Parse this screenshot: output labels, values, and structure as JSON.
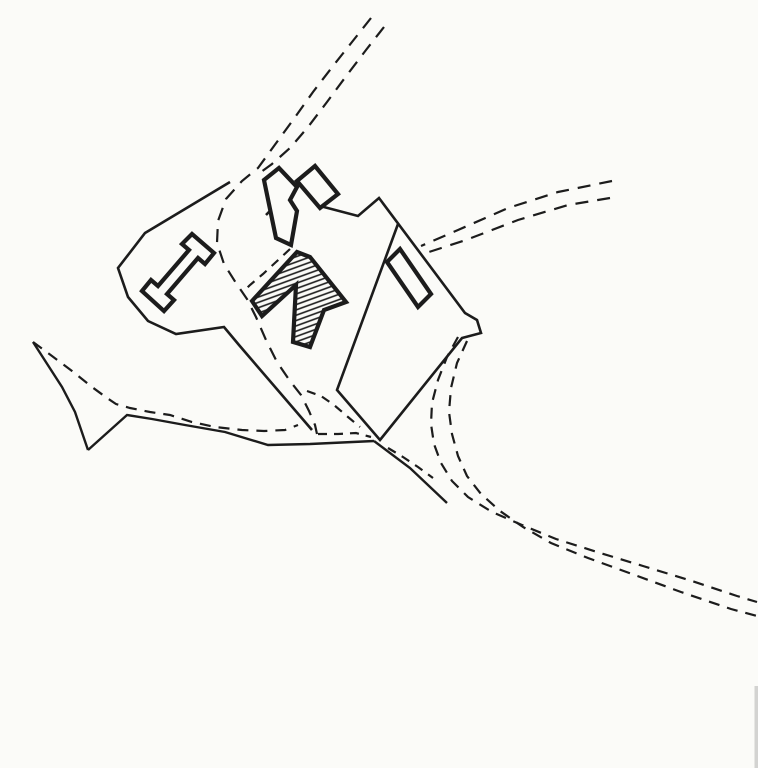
{
  "canvas": {
    "width": 758,
    "height": 768,
    "background": "#fbfbf8",
    "ink": "#1c1c1c"
  },
  "hatch": {
    "angle_deg": -20,
    "spacing": 5,
    "stroke_width": 1.6
  },
  "styles": {
    "wall": {
      "width": 2.6,
      "dash": ""
    },
    "building": {
      "width": 4.2,
      "dash": ""
    },
    "road_solid": {
      "width": 2.4,
      "dash": ""
    },
    "road_dashed": {
      "width": 2.2,
      "dash": "13 9"
    },
    "track_dashed": {
      "width": 2.2,
      "dash": "11 8"
    },
    "inner_dashed": {
      "width": 2.2,
      "dash": "9 7"
    }
  },
  "shapes": [
    {
      "name": "north-approach-road-west-line",
      "type": "polyline",
      "style": "road_dashed",
      "fill": "none",
      "points": [
        [
          371,
          18
        ],
        [
          352,
          42
        ],
        [
          333,
          66
        ],
        [
          313,
          92
        ],
        [
          293,
          120
        ],
        [
          274,
          146
        ],
        [
          258,
          168
        ],
        [
          242,
          181
        ],
        [
          226,
          199
        ],
        [
          218,
          221
        ],
        [
          217,
          243
        ],
        [
          224,
          264
        ],
        [
          236,
          283
        ],
        [
          247,
          299
        ],
        [
          256,
          317
        ],
        [
          266,
          340
        ],
        [
          277,
          362
        ],
        [
          290,
          381
        ],
        [
          301,
          395
        ],
        [
          309,
          411
        ],
        [
          315,
          425
        ],
        [
          317,
          434
        ]
      ]
    },
    {
      "name": "north-approach-road-east-line",
      "type": "polyline",
      "style": "road_dashed",
      "fill": "none",
      "points": [
        [
          384,
          27
        ],
        [
          366,
          50
        ],
        [
          347,
          75
        ],
        [
          327,
          102
        ],
        [
          308,
          127
        ],
        [
          290,
          148
        ],
        [
          272,
          164
        ],
        [
          261,
          172
        ]
      ]
    },
    {
      "name": "inner-track-east-edge",
      "type": "polyline",
      "style": "inner_dashed",
      "fill": "none",
      "points": [
        [
          290,
          249
        ],
        [
          276,
          262
        ],
        [
          263,
          274
        ],
        [
          250,
          285
        ],
        [
          244,
          291
        ]
      ]
    },
    {
      "name": "inner-fork-east-branch",
      "type": "polyline",
      "style": "inner_dashed",
      "fill": "none",
      "points": [
        [
          307,
          391
        ],
        [
          321,
          396
        ],
        [
          334,
          405
        ],
        [
          348,
          417
        ],
        [
          360,
          427
        ]
      ]
    },
    {
      "name": "inner-fork-south-branch",
      "type": "polyline",
      "style": "inner_dashed",
      "fill": "none",
      "points": [
        [
          318,
          434
        ],
        [
          338,
          434
        ],
        [
          356,
          433
        ],
        [
          371,
          437
        ]
      ]
    },
    {
      "name": "east-road-north-line",
      "type": "polyline",
      "style": "road_dashed",
      "fill": "none",
      "points": [
        [
          612,
          181
        ],
        [
          558,
          192
        ],
        [
          508,
          208
        ],
        [
          458,
          230
        ],
        [
          421,
          246
        ]
      ]
    },
    {
      "name": "east-road-south-line",
      "type": "polyline",
      "style": "road_dashed",
      "fill": "none",
      "points": [
        [
          610,
          198
        ],
        [
          568,
          205
        ],
        [
          518,
          220
        ],
        [
          466,
          240
        ],
        [
          429,
          252
        ]
      ]
    },
    {
      "name": "bypass-track-west-line",
      "type": "polyline",
      "style": "track_dashed",
      "fill": "none",
      "points": [
        [
          458,
          337
        ],
        [
          447,
          357
        ],
        [
          438,
          380
        ],
        [
          432,
          403
        ],
        [
          431,
          424
        ],
        [
          434,
          444
        ],
        [
          441,
          463
        ],
        [
          452,
          481
        ],
        [
          468,
          497
        ],
        [
          492,
          512
        ],
        [
          522,
          525
        ],
        [
          556,
          539
        ],
        [
          597,
          552
        ],
        [
          643,
          566
        ],
        [
          692,
          581
        ],
        [
          737,
          596
        ],
        [
          757,
          602
        ]
      ]
    },
    {
      "name": "bypass-track-east-line",
      "type": "polyline",
      "style": "track_dashed",
      "fill": "none",
      "points": [
        [
          467,
          341
        ],
        [
          457,
          363
        ],
        [
          451,
          388
        ],
        [
          449,
          412
        ],
        [
          452,
          434
        ],
        [
          458,
          456
        ],
        [
          467,
          476
        ],
        [
          481,
          494
        ],
        [
          500,
          511
        ],
        [
          523,
          527
        ],
        [
          551,
          543
        ],
        [
          588,
          558
        ],
        [
          632,
          574
        ],
        [
          681,
          592
        ],
        [
          731,
          609
        ],
        [
          757,
          616
        ]
      ]
    },
    {
      "name": "junction-connector-track",
      "type": "polyline",
      "style": "inner_dashed",
      "fill": "none",
      "points": [
        [
          388,
          448
        ],
        [
          403,
          457
        ],
        [
          418,
          467
        ],
        [
          433,
          478
        ]
      ]
    },
    {
      "name": "west-road-dashed-line",
      "type": "polyline",
      "style": "track_dashed",
      "fill": "none",
      "points": [
        [
          33,
          342
        ],
        [
          52,
          356
        ],
        [
          72,
          371
        ],
        [
          92,
          387
        ],
        [
          107,
          398
        ],
        [
          116,
          404
        ],
        [
          130,
          408
        ],
        [
          150,
          412
        ],
        [
          170,
          415
        ],
        [
          192,
          422
        ],
        [
          215,
          427
        ],
        [
          242,
          430
        ],
        [
          264,
          431
        ],
        [
          285,
          430
        ],
        [
          298,
          425
        ]
      ]
    },
    {
      "name": "west-road-south-edge",
      "type": "polyline",
      "style": "road_solid",
      "fill": "none",
      "points": [
        [
          88,
          450
        ],
        [
          127,
          415
        ],
        [
          152,
          419
        ],
        [
          185,
          425
        ],
        [
          225,
          432
        ],
        [
          268,
          445
        ],
        [
          310,
          444
        ],
        [
          374,
          441
        ]
      ]
    },
    {
      "name": "field-boundary-spike",
      "type": "polyline",
      "style": "road_solid",
      "fill": "none",
      "points": [
        [
          33,
          342
        ],
        [
          62,
          387
        ],
        [
          75,
          412
        ],
        [
          88,
          450
        ]
      ]
    },
    {
      "name": "se-road-north-edge",
      "type": "polyline",
      "style": "road_solid",
      "fill": "none",
      "points": [
        [
          374,
          441
        ],
        [
          410,
          468
        ],
        [
          447,
          503
        ]
      ]
    },
    {
      "name": "west-enclosure-wall",
      "type": "polyline",
      "style": "wall",
      "fill": "none",
      "points": [
        [
          230,
          182
        ],
        [
          145,
          233
        ],
        [
          118,
          268
        ],
        [
          128,
          297
        ],
        [
          148,
          321
        ],
        [
          176,
          334
        ],
        [
          224,
          327
        ],
        [
          239,
          345
        ],
        [
          312,
          430
        ]
      ]
    },
    {
      "name": "main-enclosure-wall",
      "type": "polyline",
      "style": "wall",
      "fill": "none",
      "points": [
        [
          266,
          215
        ],
        [
          298,
          182
        ],
        [
          320,
          206
        ],
        [
          358,
          216
        ],
        [
          379,
          198
        ],
        [
          465,
          313
        ],
        [
          477,
          320
        ],
        [
          481,
          333
        ],
        [
          462,
          338
        ],
        [
          380,
          440
        ],
        [
          337,
          390
        ],
        [
          398,
          224
        ]
      ]
    },
    {
      "name": "hatched-range-building",
      "type": "polygon",
      "style": "building",
      "fill": "hatch",
      "points": [
        [
          252,
          301
        ],
        [
          297,
          252
        ],
        [
          310,
          257
        ],
        [
          346,
          302
        ],
        [
          324,
          310
        ],
        [
          310,
          347
        ],
        [
          293,
          342
        ],
        [
          296,
          285
        ],
        [
          262,
          316
        ]
      ]
    },
    {
      "name": "hall-building-i-plan",
      "type": "polygon",
      "style": "building",
      "fill": "paper",
      "points": [
        [
          142,
          291
        ],
        [
          151,
          280
        ],
        [
          158,
          286
        ],
        [
          189,
          250
        ],
        [
          182,
          244
        ],
        [
          192,
          234
        ],
        [
          214,
          253
        ],
        [
          205,
          264
        ],
        [
          198,
          258
        ],
        [
          167,
          294
        ],
        [
          174,
          300
        ],
        [
          164,
          311
        ]
      ]
    },
    {
      "name": "north-tower-building",
      "type": "polygon",
      "style": "building",
      "fill": "paper",
      "points": [
        [
          297,
          181
        ],
        [
          315,
          166
        ],
        [
          338,
          194
        ],
        [
          320,
          208
        ]
      ]
    },
    {
      "name": "gate-building",
      "type": "polygon",
      "style": "building",
      "fill": "paper",
      "points": [
        [
          264,
          180
        ],
        [
          279,
          168
        ],
        [
          297,
          187
        ],
        [
          290,
          200
        ],
        [
          297,
          211
        ],
        [
          291,
          245
        ],
        [
          276,
          238
        ]
      ]
    },
    {
      "name": "east-range-building",
      "type": "polygon",
      "style": "building",
      "fill": "paper",
      "points": [
        [
          387,
          262
        ],
        [
          400,
          249
        ],
        [
          431,
          294
        ],
        [
          418,
          307
        ]
      ]
    }
  ],
  "artifacts": {
    "scan_edge": {
      "x": 754.5,
      "y": 686,
      "width": 3.5,
      "height": 82,
      "color": "#8a8a8a",
      "opacity": 0.35
    }
  }
}
